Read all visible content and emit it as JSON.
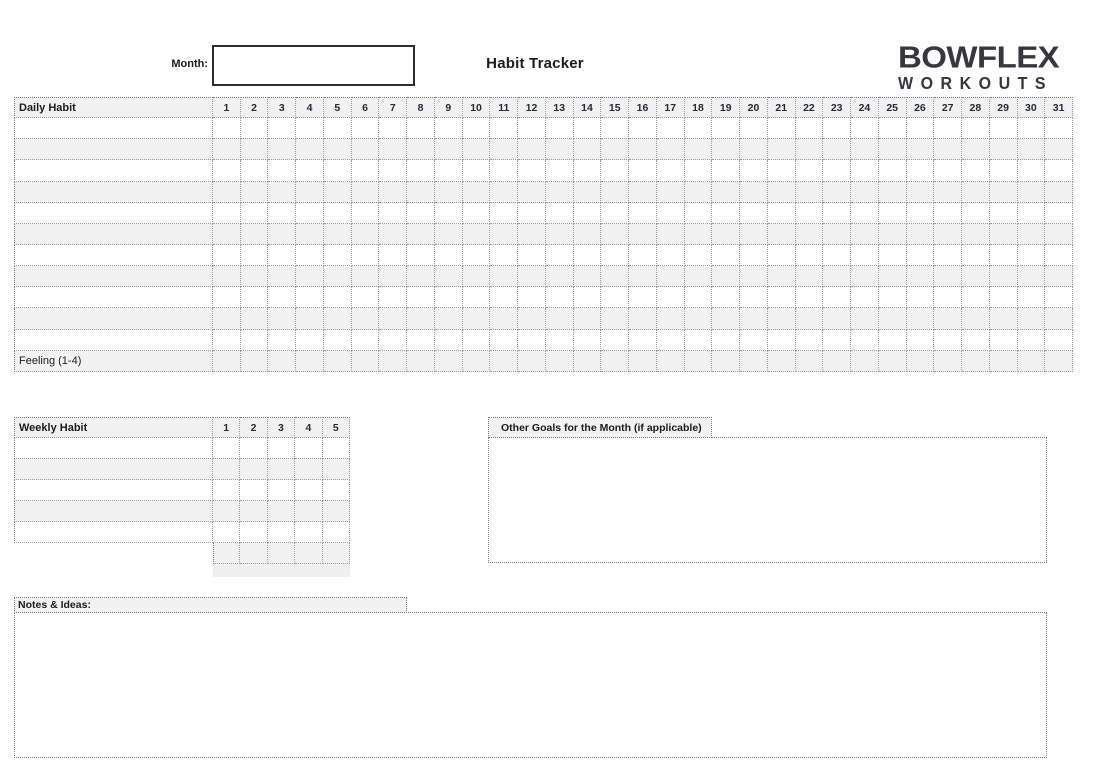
{
  "header": {
    "month_label": "Month:",
    "month_value": "",
    "title": "Habit Tracker",
    "logo": {
      "line1": "BOWFLEX",
      "line2": "WORKOUTS"
    }
  },
  "daily_table": {
    "header_label": "Daily Habit",
    "day_columns": [
      "1",
      "2",
      "3",
      "4",
      "5",
      "6",
      "7",
      "8",
      "9",
      "10",
      "11",
      "12",
      "13",
      "14",
      "15",
      "16",
      "17",
      "18",
      "19",
      "20",
      "21",
      "22",
      "23",
      "24",
      "25",
      "26",
      "27",
      "28",
      "29",
      "30",
      "31"
    ],
    "habit_rows": [
      "",
      "",
      "",
      "",
      "",
      "",
      "",
      "",
      "",
      "",
      ""
    ],
    "footer_label": "Feeling (1-4)",
    "cell_values": []
  },
  "weekly_table": {
    "header_label": "Weekly Habit",
    "week_columns": [
      "1",
      "2",
      "3",
      "4",
      "5"
    ],
    "habit_rows": [
      "",
      "",
      "",
      "",
      ""
    ],
    "has_extra_grid_row": true,
    "cell_values": []
  },
  "other_goals": {
    "title": "Other Goals for the Month (if applicable)",
    "content": ""
  },
  "notes": {
    "title": "Notes & Ideas:",
    "content": ""
  },
  "colors": {
    "fill_gray": "#f1f1f1",
    "strip_gray": "#efefef",
    "grid_line": "#9a9a9a",
    "grid_line_dark": "#7b7b7b",
    "text": "#1c1c1c",
    "number_text": "#272b33",
    "logo": "#37373d",
    "month_box_border": "#2d2d2d",
    "page_bg": "#ffffff"
  }
}
